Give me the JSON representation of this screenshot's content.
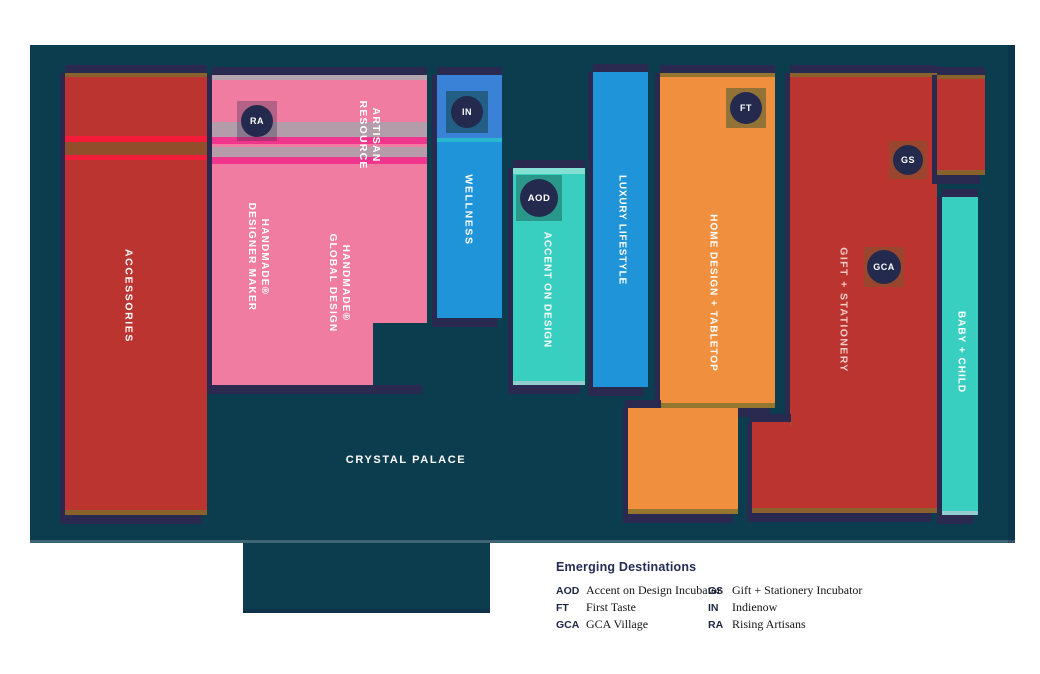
{
  "map": {
    "title_hint": "venue floor plan",
    "crystal_palace": {
      "label": "CRYSTAL PALACE"
    },
    "zones": {
      "accessories": {
        "label": "ACCESSORIES",
        "color": "#bb3430"
      },
      "artisan_resource": {
        "line1": "ARTISAN",
        "line2": "RESOURCE",
        "color": "#f07da1"
      },
      "handmade_designer_maker": {
        "line1": "HANDMADE®",
        "line2": "DESIGNER MAKER",
        "color": "#f07da1"
      },
      "handmade_global_design": {
        "line1": "HANDMADE®",
        "line2": "GLOBAL DESIGN",
        "color": "#f07da1"
      },
      "wellness": {
        "label": "WELLNESS",
        "color": "#2094d8"
      },
      "accent_on_design": {
        "label": "ACCENT ON DESIGN",
        "color": "#39cfc0"
      },
      "luxury_lifestyle": {
        "label": "LUXURY LIFESTYLE",
        "color": "#2094d8"
      },
      "home_design_tabletop": {
        "label": "HOME DESIGN + TABLETOP",
        "color": "#f0903f"
      },
      "gift_stationery": {
        "label": "GIFT + STATIONERY",
        "color": "#bb3430"
      },
      "baby_child": {
        "label": "BABY + CHILD",
        "color": "#39cfc0"
      }
    },
    "badges": {
      "ra": "RA",
      "in": "IN",
      "aod": "AOD",
      "ft": "FT",
      "gs": "GS",
      "gca": "GCA"
    },
    "colors": {
      "map_background": "#0b3d4e",
      "shadow_navy": "#2a2950",
      "edge_olive": "#7a6e2a",
      "badge_navy": "#232a4d",
      "label_text": "#ffffff"
    }
  },
  "legend": {
    "title": "Emerging Destinations",
    "entries": [
      {
        "code": "AOD",
        "name": "Accent on Design Incubator"
      },
      {
        "code": "FT",
        "name": "First Taste"
      },
      {
        "code": "GCA",
        "name": "GCA Village"
      },
      {
        "code": "GS",
        "name": "Gift + Stationery Incubator"
      },
      {
        "code": "IN",
        "name": "Indienow"
      },
      {
        "code": "RA",
        "name": "Rising Artisans"
      }
    ]
  }
}
